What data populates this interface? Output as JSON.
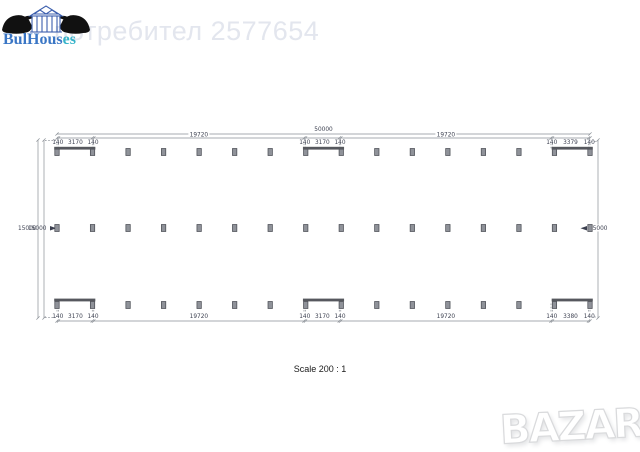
{
  "header": {
    "brand_part1": "BulHous",
    "brand_part2": "es",
    "watermark": "потребител 2577654"
  },
  "icons": {
    "logo_left": "bull-silhouette-left",
    "logo_right": "bull-silhouette-right",
    "logo_center": "timber-house-frame"
  },
  "footer": {
    "scale_label": "Scale 200 : 1",
    "bazar_text": "BAZAR"
  },
  "colors": {
    "brand_blue": "#3a76c5",
    "brand_teal": "#35b3c9",
    "house_blue": "#3c5fae",
    "bull_black": "#111111",
    "watermark": "#e3e6ee",
    "dim_line": "#8a8f96",
    "dim_text": "#3c4050",
    "column_fill": "#8f9299",
    "column_stroke": "#45484f",
    "wall": "#56585e"
  },
  "plan": {
    "overall_width_mm": 50000,
    "overall_width_label": "50000",
    "height_labels_left": [
      "15000",
      "15000"
    ],
    "height_label_right": "15000",
    "columns_per_row": 16,
    "row_count": 3,
    "wall_bays": [
      [
        0,
        1
      ],
      [
        7,
        8
      ],
      [
        14,
        15
      ]
    ],
    "top_segments": [
      {
        "label": "140",
        "mm": 140
      },
      {
        "label": "3170",
        "mm": 3170
      },
      {
        "label": "140",
        "mm": 140
      },
      {
        "label": "19720",
        "mm": 19720
      },
      {
        "label": "140",
        "mm": 140
      },
      {
        "label": "3170",
        "mm": 3170
      },
      {
        "label": "140",
        "mm": 140
      },
      {
        "label": "19720",
        "mm": 19720
      },
      {
        "label": "140",
        "mm": 140
      },
      {
        "label": "3379",
        "mm": 3379
      },
      {
        "label": "140",
        "mm": 140
      }
    ],
    "bottom_segments": [
      {
        "label": "140",
        "mm": 140
      },
      {
        "label": "3170",
        "mm": 3170
      },
      {
        "label": "140",
        "mm": 140
      },
      {
        "label": "19720",
        "mm": 19720
      },
      {
        "label": "140",
        "mm": 140
      },
      {
        "label": "3170",
        "mm": 3170
      },
      {
        "label": "140",
        "mm": 140
      },
      {
        "label": "19720",
        "mm": 19720
      },
      {
        "label": "140",
        "mm": 140
      },
      {
        "label": "3380",
        "mm": 3380
      },
      {
        "label": "140",
        "mm": 140
      }
    ]
  }
}
